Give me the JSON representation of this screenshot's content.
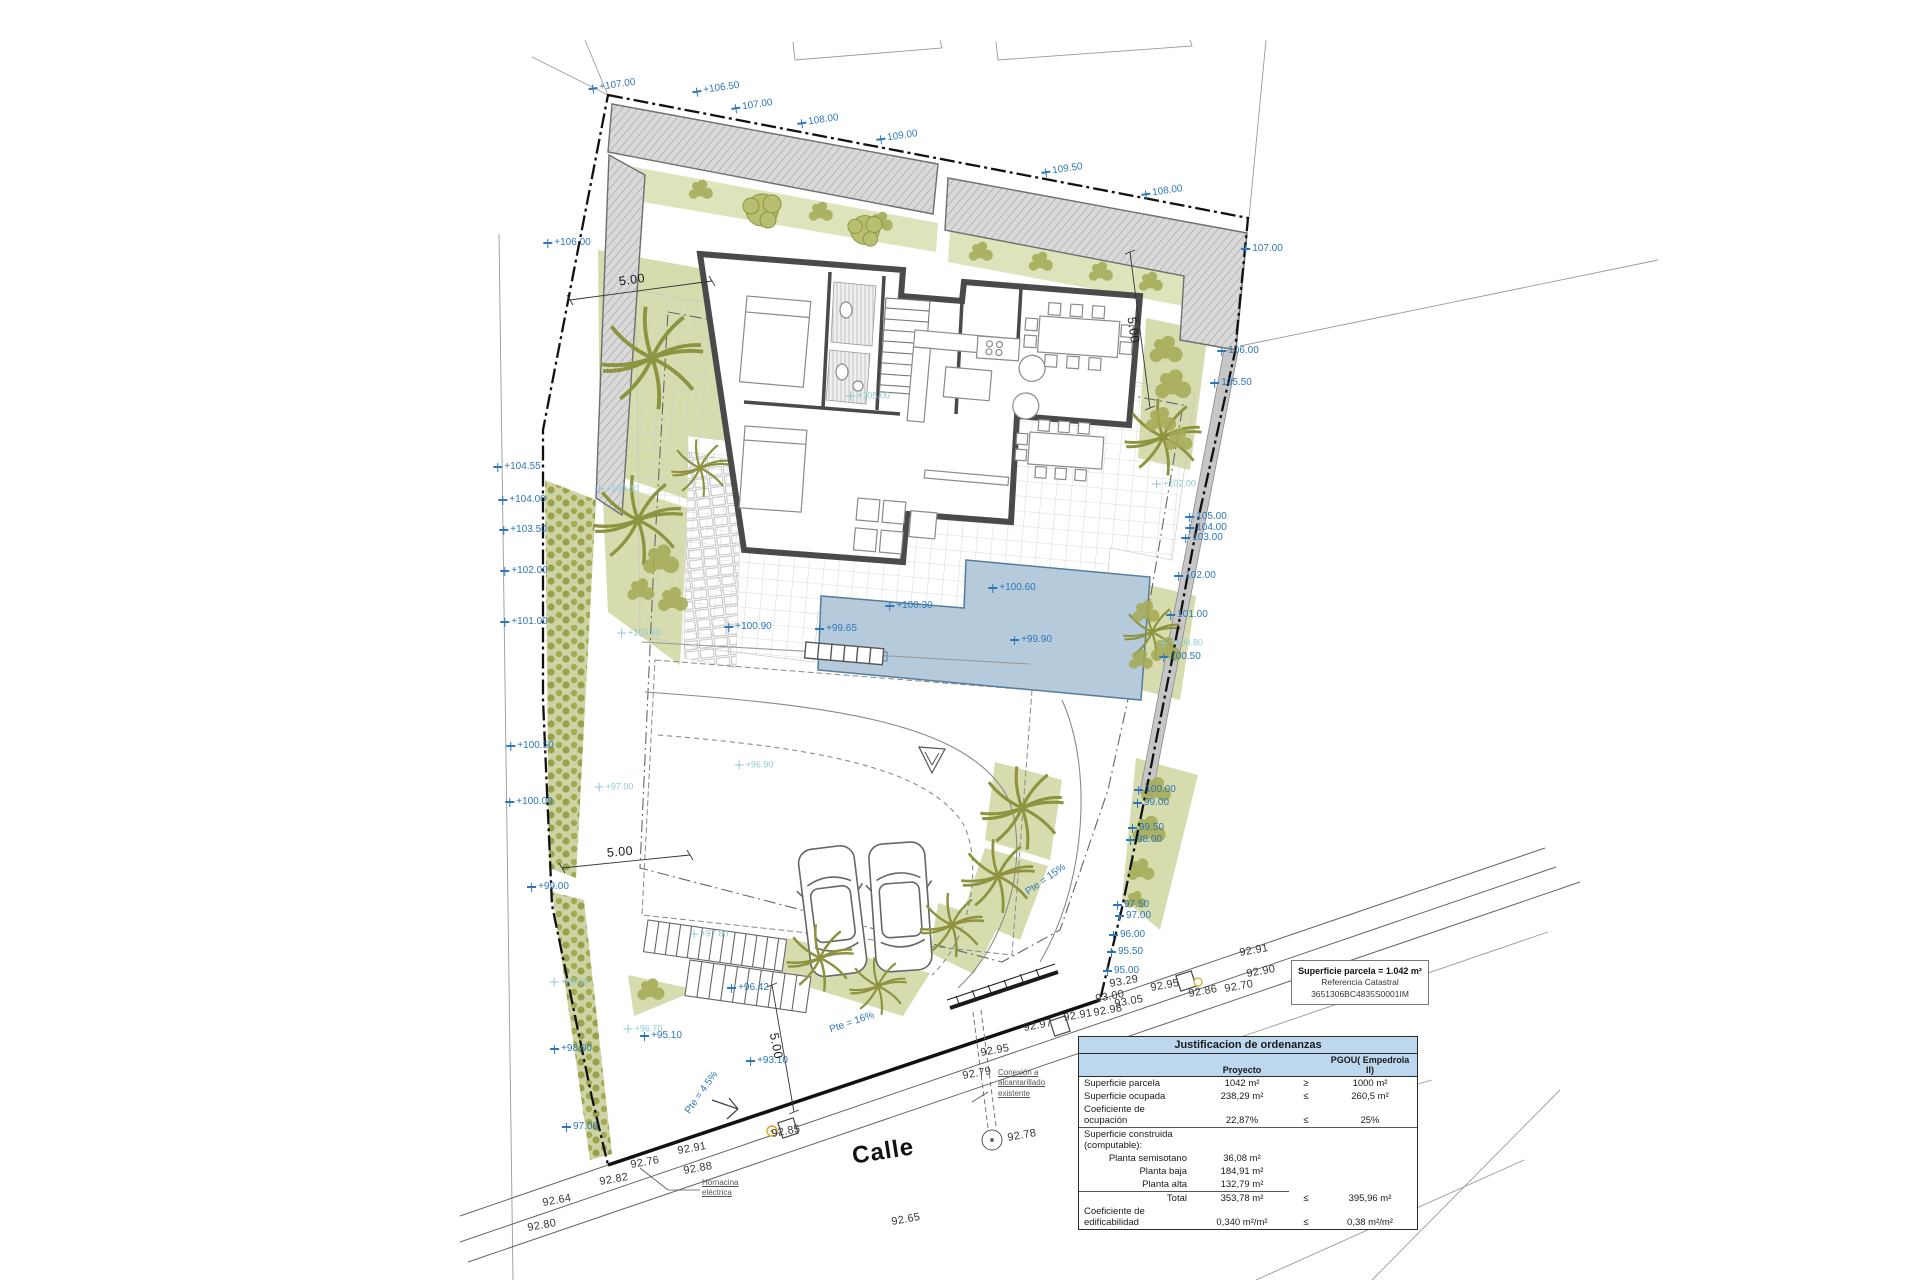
{
  "street": {
    "calle_label": "Calle"
  },
  "notes": {
    "hornacina": "Hornacina\neléctrica",
    "conexion": "Conexión a\nalcantarillado\nexistente"
  },
  "parcel_info_box": {
    "line1": "Superficie parcela = 1.042 m²",
    "line2": "Referencia Catastral",
    "line3": "3651306BC4835S0001IM"
  },
  "ordenanzas_table": {
    "title": "Justificacion de ordenanzas",
    "col_proyecto": "Proyecto",
    "col_pgou": "PGOU( Empedrola II)",
    "rows": [
      {
        "label": "Superficie parcela",
        "proyecto": "1042 m²",
        "cmp": "≥",
        "pgou": "1000 m²"
      },
      {
        "label": "Superficie ocupada",
        "proyecto": "238,29 m²",
        "cmp": "≤",
        "pgou": "260,5 m²"
      },
      {
        "label": "Coeficiente de ocupación",
        "proyecto": "22,87%",
        "cmp": "≤",
        "pgou": "25%"
      },
      {
        "label": "Superficie construida (computable):",
        "proyecto": "",
        "cmp": "",
        "pgou": "",
        "rule": true
      },
      {
        "label": "Planta semisotano",
        "proyecto": "36,08 m²",
        "cmp": "",
        "pgou": "",
        "indent": true
      },
      {
        "label": "Planta baja",
        "proyecto": "184,91 m²",
        "cmp": "",
        "pgou": "",
        "indent": true
      },
      {
        "label": "Planta alta",
        "proyecto": "132,79 m²",
        "cmp": "",
        "pgou": "",
        "indent": true,
        "underline": true
      },
      {
        "label": "Total",
        "proyecto": "353,78 m²",
        "cmp": "≤",
        "pgou": "395,96 m²",
        "indent": true
      },
      {
        "label": "Coeficiente de edificabilidad",
        "proyecto": "0,340 m²/m²",
        "cmp": "≤",
        "pgou": "0,38 m²/m²"
      }
    ]
  },
  "colors": {
    "label_blue": "#2e77b8",
    "label_pale_teal": "#8fc9d4",
    "garden_green": "#d6dcae",
    "pool_blue": "#b5cadb",
    "wall_gray": "#d9d9d9",
    "table_header_blue": "#bdd7ee"
  },
  "plan_labels": [
    {
      "name": "elevation-label",
      "cls": "lbl-blue",
      "marker": true,
      "rot": -8,
      "items": [
        {
          "x": 612,
          "y": 86,
          "t": "+107.00"
        },
        {
          "x": 716,
          "y": 89,
          "t": "+106.50"
        },
        {
          "x": 752,
          "y": 106,
          "t": "107.00"
        },
        {
          "x": 818,
          "y": 121,
          "t": "108.00"
        },
        {
          "x": 897,
          "y": 137,
          "t": "109.00"
        },
        {
          "x": 1062,
          "y": 170,
          "t": "109.50"
        },
        {
          "x": 1162,
          "y": 192,
          "t": "108.00"
        }
      ]
    },
    {
      "name": "elevation-label",
      "cls": "lbl-blue",
      "marker": true,
      "rot": 0,
      "items": [
        {
          "x": 1262,
          "y": 249,
          "t": "107.00"
        },
        {
          "x": 1238,
          "y": 351,
          "t": "106.00"
        },
        {
          "x": 1231,
          "y": 383,
          "t": "105.50"
        },
        {
          "x": 1206,
          "y": 517,
          "t": "105.00"
        },
        {
          "x": 1206,
          "y": 528,
          "t": "104.00"
        },
        {
          "x": 1202,
          "y": 538,
          "t": "103.00"
        },
        {
          "x": 1195,
          "y": 576,
          "t": "102.00"
        },
        {
          "x": 1187,
          "y": 615,
          "t": "101.00"
        },
        {
          "x": 1180,
          "y": 657,
          "t": "100.50"
        },
        {
          "x": 1155,
          "y": 790,
          "t": "100.00"
        },
        {
          "x": 1151,
          "y": 803,
          "t": "99.00"
        },
        {
          "x": 1146,
          "y": 828,
          "t": "99.50"
        },
        {
          "x": 1144,
          "y": 840,
          "t": "98.00"
        },
        {
          "x": 1131,
          "y": 905,
          "t": "97.50"
        },
        {
          "x": 1133,
          "y": 916,
          "t": "97.00"
        },
        {
          "x": 1127,
          "y": 935,
          "t": "96.00"
        },
        {
          "x": 1125,
          "y": 952,
          "t": "95.50"
        },
        {
          "x": 1121,
          "y": 971,
          "t": "95.00"
        }
      ]
    },
    {
      "name": "elevation-label",
      "cls": "lbl-blue",
      "marker": true,
      "rot": 0,
      "items": [
        {
          "x": 567,
          "y": 243,
          "t": "+106.00"
        },
        {
          "x": 517,
          "y": 467,
          "t": "+104.55"
        },
        {
          "x": 522,
          "y": 500,
          "t": "+104.00"
        },
        {
          "x": 523,
          "y": 530,
          "t": "+103.50"
        },
        {
          "x": 524,
          "y": 571,
          "t": "+102.00"
        },
        {
          "x": 524,
          "y": 622,
          "t": "+101.00"
        },
        {
          "x": 530,
          "y": 746,
          "t": "+100.50"
        },
        {
          "x": 529,
          "y": 802,
          "t": "+100.00"
        },
        {
          "x": 548,
          "y": 887,
          "t": "+99.00"
        },
        {
          "x": 571,
          "y": 1049,
          "t": "+98.00"
        },
        {
          "x": 580,
          "y": 1127,
          "t": "97.00"
        }
      ]
    },
    {
      "name": "elevation-label",
      "cls": "lbl-blue",
      "marker": true,
      "rot": 0,
      "items": [
        {
          "x": 748,
          "y": 627,
          "t": "+100.90"
        },
        {
          "x": 1012,
          "y": 588,
          "t": "+100.60"
        },
        {
          "x": 909,
          "y": 606,
          "t": "+100.30"
        },
        {
          "x": 836,
          "y": 629,
          "t": "+99.65"
        },
        {
          "x": 1031,
          "y": 640,
          "t": "+99.90"
        },
        {
          "x": 748,
          "y": 988,
          "t": "+96.42"
        },
        {
          "x": 661,
          "y": 1036,
          "t": "+95.10"
        },
        {
          "x": 767,
          "y": 1061,
          "t": "+93.10"
        }
      ]
    },
    {
      "name": "garden-elevation-label",
      "cls": "lbl-pale",
      "marker": true,
      "rot": 0,
      "items": [
        {
          "x": 868,
          "y": 396,
          "t": "+105.00"
        },
        {
          "x": 617,
          "y": 489,
          "t": "+100.80"
        },
        {
          "x": 639,
          "y": 633,
          "t": "+100.90"
        },
        {
          "x": 1174,
          "y": 484,
          "t": "+102.00"
        },
        {
          "x": 1181,
          "y": 643,
          "t": "+100.80"
        },
        {
          "x": 614,
          "y": 787,
          "t": "+97.00"
        },
        {
          "x": 709,
          "y": 934,
          "t": "+97.80"
        },
        {
          "x": 643,
          "y": 1029,
          "t": "+96.70"
        },
        {
          "x": 754,
          "y": 765,
          "t": "+96.90"
        },
        {
          "x": 569,
          "y": 982,
          "t": "+98.50"
        }
      ]
    },
    {
      "name": "street-elevation-label",
      "cls": "lbl-black",
      "marker": false,
      "rot": -10,
      "items": [
        {
          "x": 1124,
          "y": 982,
          "t": "93.29"
        },
        {
          "x": 1129,
          "y": 1002,
          "t": "93.05"
        },
        {
          "x": 1110,
          "y": 997,
          "t": "93.00"
        },
        {
          "x": 1108,
          "y": 1011,
          "t": "92.98"
        },
        {
          "x": 1078,
          "y": 1016,
          "t": "92.91"
        },
        {
          "x": 1165,
          "y": 986,
          "t": "92.95"
        },
        {
          "x": 1203,
          "y": 992,
          "t": "92.86"
        },
        {
          "x": 1239,
          "y": 987,
          "t": "92.70"
        },
        {
          "x": 1261,
          "y": 972,
          "t": "92.90"
        },
        {
          "x": 1254,
          "y": 951,
          "t": "92.91"
        },
        {
          "x": 995,
          "y": 1051,
          "t": "92.95"
        },
        {
          "x": 977,
          "y": 1074,
          "t": "92.79"
        },
        {
          "x": 1038,
          "y": 1026,
          "t": "92.97"
        },
        {
          "x": 692,
          "y": 1149,
          "t": "92.91"
        },
        {
          "x": 698,
          "y": 1169,
          "t": "92.88"
        },
        {
          "x": 645,
          "y": 1163,
          "t": "92.76"
        },
        {
          "x": 614,
          "y": 1180,
          "t": "92.82"
        },
        {
          "x": 557,
          "y": 1201,
          "t": "92.64"
        },
        {
          "x": 542,
          "y": 1226,
          "t": "92.80"
        },
        {
          "x": 906,
          "y": 1220,
          "t": "92.65"
        },
        {
          "x": 1022,
          "y": 1136,
          "t": "92.78"
        },
        {
          "x": 786,
          "y": 1132,
          "t": "92.85"
        },
        {
          "x": 1186,
          "y": 1174,
          "t": "92.83"
        }
      ]
    },
    {
      "name": "setback-dimension-label",
      "cls": "lbl-dim",
      "marker": false,
      "rot": 0,
      "items": [
        {
          "x": 632,
          "y": 280,
          "t": "5.00",
          "r": -8
        },
        {
          "x": 1133,
          "y": 330,
          "t": "5.00",
          "r": 82
        },
        {
          "x": 620,
          "y": 852,
          "t": "5.00",
          "r": -5
        },
        {
          "x": 776,
          "y": 1046,
          "t": "5.00",
          "r": 79
        }
      ]
    },
    {
      "name": "slope-label",
      "cls": "lbl-slope",
      "marker": false,
      "rot": 0,
      "items": [
        {
          "x": 1046,
          "y": 880,
          "t": "Pte = 15%",
          "r": -35
        },
        {
          "x": 852,
          "y": 1023,
          "t": "Pte = 16%",
          "r": -19
        },
        {
          "x": 702,
          "y": 1093,
          "t": "Pte = 4.5%",
          "r": -55
        }
      ]
    }
  ]
}
